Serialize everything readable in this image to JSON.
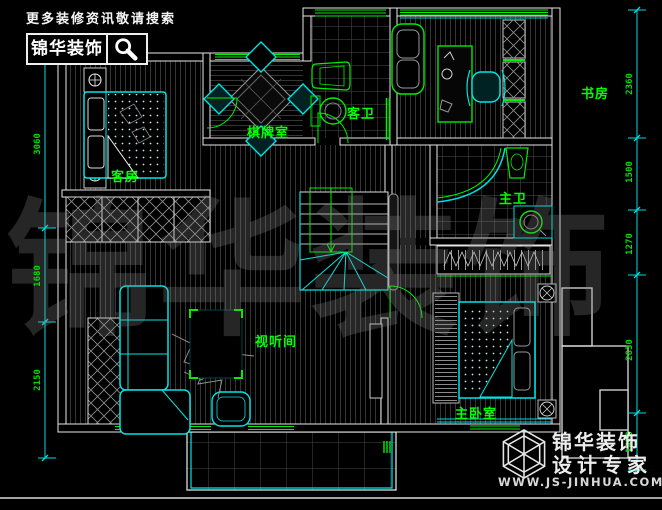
{
  "header": {
    "tagline": "更多装修资讯敬请搜索",
    "brand": "锦华装饰"
  },
  "rooms": [
    {
      "id": "guest-room",
      "label": "客房"
    },
    {
      "id": "chess-room",
      "label": "棋牌室"
    },
    {
      "id": "guest-bath",
      "label": "客卫"
    },
    {
      "id": "study",
      "label": "书房"
    },
    {
      "id": "master-bath",
      "label": "主卫"
    },
    {
      "id": "av-room",
      "label": "视听间"
    },
    {
      "id": "master-bedroom",
      "label": "主卧室"
    }
  ],
  "dimensions": {
    "left": [
      "3060",
      "1680",
      "2150"
    ],
    "right": [
      "2360",
      "1500",
      "1270",
      "2830",
      "1470"
    ]
  },
  "watermark": "锦华装饰",
  "footer_logo": {
    "brand": "锦华装饰",
    "subtitle": "设计专家",
    "url": "WWW.JS-JINHUA.COM"
  },
  "colors": {
    "background": "#000000",
    "walls": "#e8e8e8",
    "furniture": "#00ffff",
    "fixtures": "#00ff00",
    "labels": "#00ff00",
    "dimension_lines": "#00ffff",
    "dimension_text": "#00dd00",
    "watermark": "#8a8a8a"
  }
}
